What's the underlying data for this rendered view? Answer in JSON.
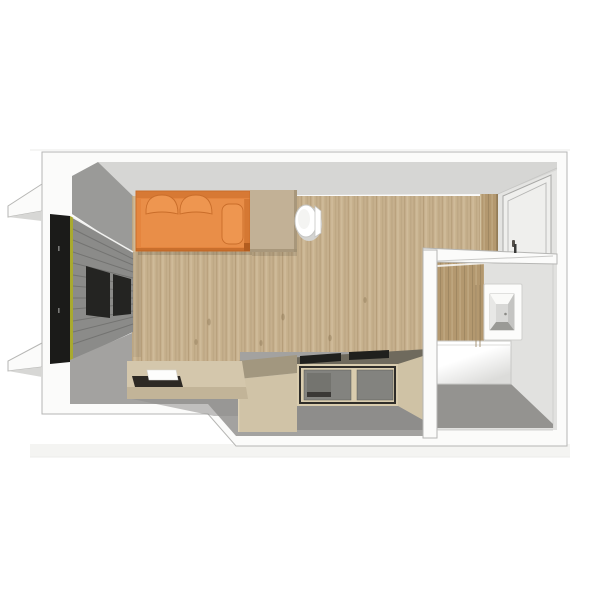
{
  "meta": {
    "title": "Top-down 3D render of a studio apartment floor plan",
    "view": "bird's-eye perspective cutaway",
    "rooms": [
      "living-area",
      "entry",
      "bathroom",
      "kitchenette"
    ],
    "furniture": [
      "sofa-daybed",
      "back-cushions",
      "bolster-pillow",
      "side-cabinet",
      "toilet",
      "window-blinds-wardrobe",
      "low-bench",
      "serving-tray",
      "book",
      "storage-column",
      "kitchen-cabinets",
      "cooktop",
      "countertop",
      "washbasin",
      "bathtub",
      "entry-door",
      "exterior-wall-fins"
    ]
  },
  "palette": {
    "page_bg": "#ffffff",
    "backdrop_line": "#ebebe9",
    "pedestal": "#f4f4f2",
    "wall_cut": "#fbfbfa",
    "wall_outline": "#b6b6b4",
    "wall_north": "#d6d6d4",
    "wall_west": "#9a9a98",
    "fin_shadow": "#d7d7d5",
    "entry_wall": "#e4e4e2",
    "door_panel": "#efefed",
    "door_frame": "#a8a8a6",
    "door_handle": "#55504a",
    "wood_base": "#c6b08d",
    "wood_dark": "#a58c68",
    "wood_light": "#d7c6a6",
    "wood_knot": "#8f7a58",
    "window_frame": "#1b1b19",
    "accent_green": "#a9aa2e",
    "blinds": "#8b8b89",
    "blinds_dark": "#242422",
    "blinds_highlight": "#f2f2f0",
    "sofa": "#e5853e",
    "sofa_seat": "#e98e48",
    "sofa_dark": "#c96d2a",
    "sofa_deep": "#b35d1f",
    "sofa_light": "#ee9650",
    "cabinet": "#c2b196",
    "cabinet_edge": "#9f8f72",
    "toilet": "#ffffff",
    "toilet_outline": "#c6c6c4",
    "toilet_shadow": "#d4d4d2",
    "floor_gray": "#a3a2a0",
    "floor_gray_dark": "#8f8e8c",
    "bench": "#d4c7ac",
    "bench_front": "#c2b498",
    "tray": "#2d2924",
    "book": "#fdfdfc",
    "column": "#d0c3a7",
    "column_top": "#a2977f",
    "countertop": "#6f6a5d",
    "cooktop": "#20201d",
    "kitchen_frame": "#d9ccae",
    "kitchen_frame_dark": "#2f2d29",
    "kitchen_front": "#83837f",
    "kitchen_front_inner": "#74746f",
    "kitchen_front_bar": "#3a3835",
    "kitchen_side": "#cfc2a5",
    "plinth": "#8e8d8b",
    "bath_wall": "#e1e1df",
    "bath_wood": "#b3986f",
    "bath_floor": "#949390",
    "tub": "#ffffff",
    "tub_shade": "#dcdcda",
    "sink_panel": "#fcfcfb",
    "basin_light": "#fafaf8",
    "basin_left": "#e8e8e6",
    "basin_right": "#c4c4c2",
    "basin_bottom": "#9a9a96",
    "basin_inner": "#d8d8d6",
    "drain": "#8a8a86"
  }
}
